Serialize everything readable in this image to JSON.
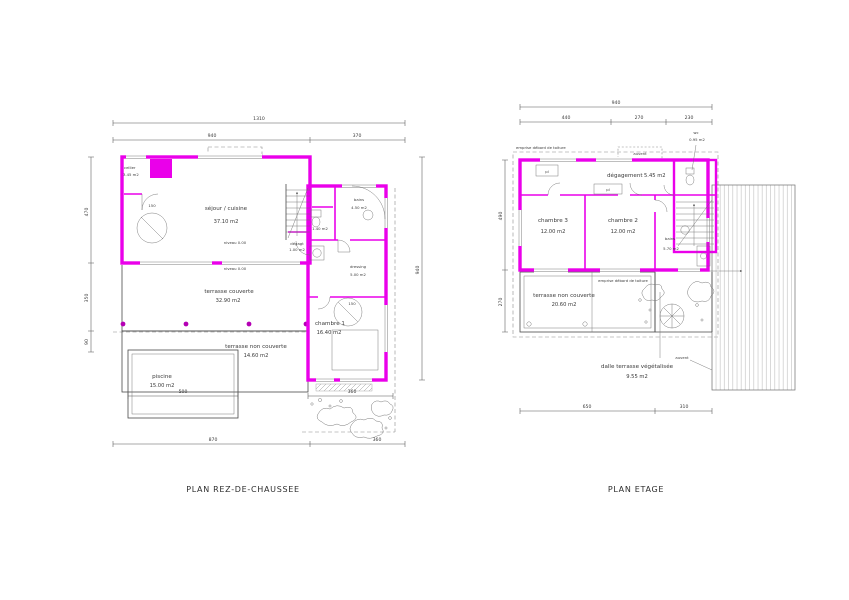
{
  "titles": {
    "ground": "PLAN REZ-DE-CHAUSSEE",
    "upper": "PLAN ETAGE"
  },
  "colors": {
    "wall": "#ea00ea",
    "post_dot": "#b400b4"
  },
  "ground_floor": {
    "rooms": {
      "cellier": {
        "name": "cellier",
        "area": "3.45 m2"
      },
      "sejour": {
        "name": "séjour / cuisine",
        "area": "37.10 m2"
      },
      "bains": {
        "name": "bains",
        "area": "4.50 m2"
      },
      "wc": {
        "area": "1.40 m2"
      },
      "degagt": {
        "name": "dégagt",
        "area": "1.00 m2"
      },
      "dressing": {
        "name": "dressing",
        "area": "5.00 m2"
      },
      "chambre1": {
        "name": "chambre 1",
        "area": "16.40 m2"
      },
      "terrasse_couverte": {
        "name": "terrasse couverte",
        "area": "32.90 m2"
      },
      "terrasse_non_couverte": {
        "name": "terrasse non couverte",
        "area": "14.60 m2"
      },
      "piscine": {
        "name": "piscine",
        "area": "15.00 m2"
      }
    },
    "annotations": {
      "niveau_a": "niveau 0.00",
      "niveau_b": "niveau 0.00",
      "diam_a": "150",
      "diam_b": "150"
    },
    "dims": {
      "total": "1310",
      "top_left": "940",
      "top_right": "370",
      "bottom_left": "870",
      "bottom_right": "360",
      "pool": "500",
      "pool_side": "360",
      "left_top": "470",
      "left_mid": "350",
      "left_bot": "90",
      "right": "940"
    }
  },
  "upper_floor": {
    "rooms": {
      "degagement": {
        "name": "dégagement",
        "area": "5.45 m2"
      },
      "wc": {
        "name": "wc",
        "area": "0.95 m2"
      },
      "chambre3": {
        "name": "chambre 3",
        "area": "12.00 m2"
      },
      "chambre2": {
        "name": "chambre 2",
        "area": "12.00 m2"
      },
      "bains": {
        "name": "bains",
        "area": "5.70 m2"
      },
      "terrasse": {
        "name": "terrasse non couverte",
        "area": "20.60 m2"
      },
      "dalle": {
        "name": "dalle terrasse végétalisée",
        "area": "9.55 m2"
      }
    },
    "annotations": {
      "emprise_a": "emprise débord de toiture",
      "emprise_b": "emprise débord de toiture",
      "auvent_a": "auvent",
      "auvent_b": "auvent",
      "pl_a": "pl",
      "pl_b": "pl"
    },
    "dims": {
      "total": "940",
      "w1": "440",
      "w2": "270",
      "w3": "230",
      "bottom_left": "650",
      "bottom_right": "310",
      "left_top": "490",
      "left_bot": "270"
    }
  }
}
